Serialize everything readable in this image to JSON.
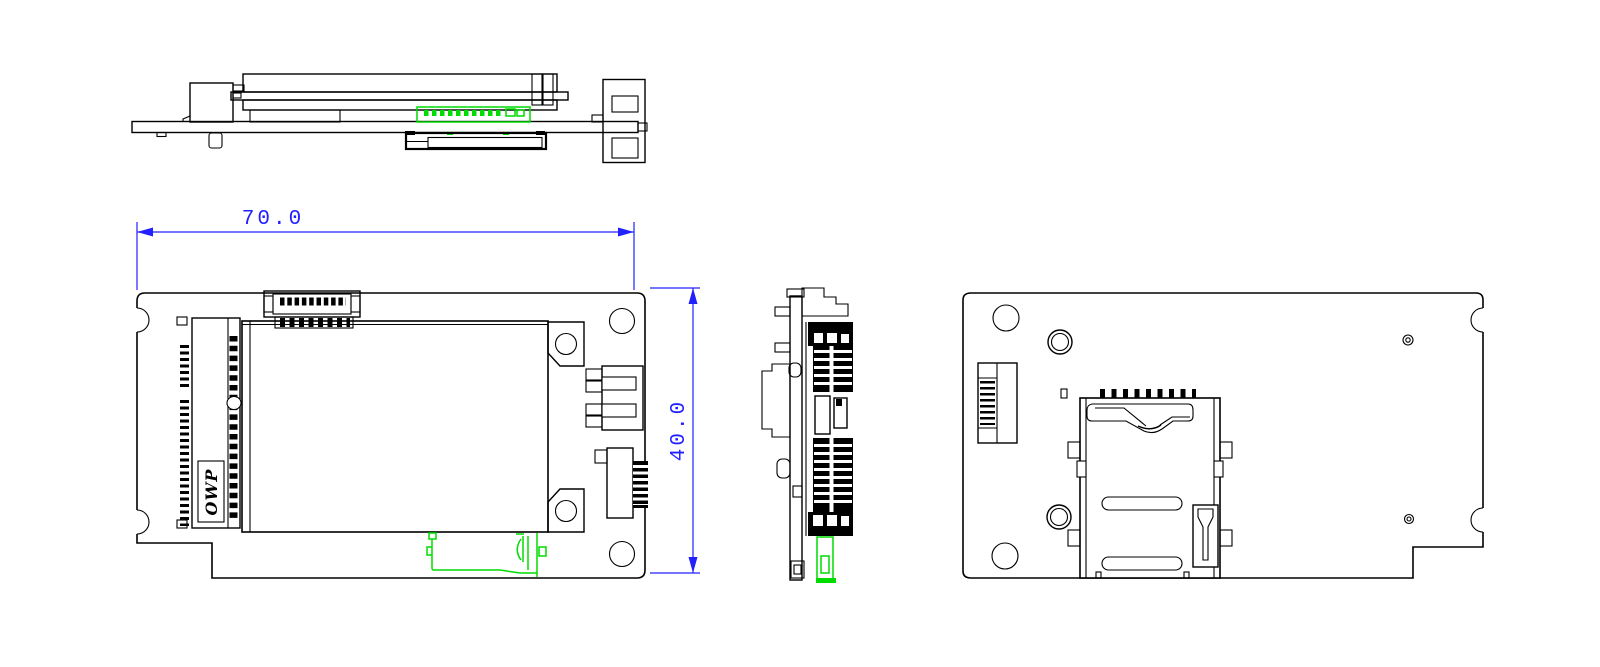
{
  "drawing": {
    "colors": {
      "line": "#000000",
      "dimension": "#2121ff",
      "highlight": "#00dc00",
      "background": "#ffffff"
    },
    "dimensions": {
      "width": {
        "label": "70.0"
      },
      "height": {
        "label": "40.0"
      }
    },
    "logo": {
      "text": "OWP"
    },
    "views": [
      {
        "name": "top-profile-view"
      },
      {
        "name": "front-view"
      },
      {
        "name": "side-profile-view"
      },
      {
        "name": "back-view"
      }
    ]
  }
}
